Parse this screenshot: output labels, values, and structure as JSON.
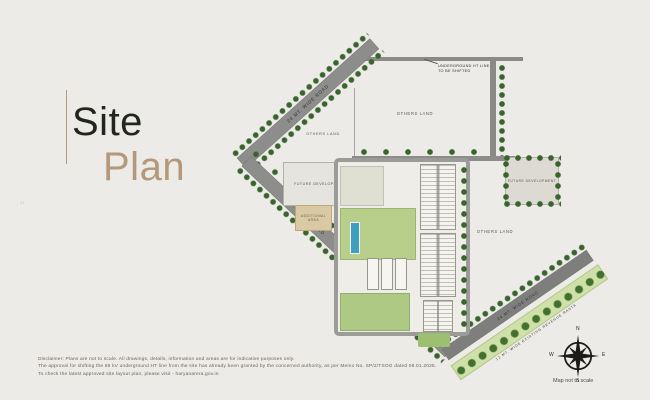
{
  "page": {
    "title_line1": "Site",
    "title_line2": "Plan",
    "page_mark": "17",
    "colors": {
      "accent_tan": "#b5987a",
      "title_dark": "#23261f",
      "road_gray": "#8d8d8b",
      "tree_green": "#3a642e",
      "lawn_green": "#b7cf8b",
      "pool_blue": "#3f9fbe",
      "additional_area_tan": "#d9c9a4"
    }
  },
  "map": {
    "labels": {
      "road_top_left": "24 MT. WIDE ROAD",
      "road_bottom_left": "24 MT. WIDE ROAD",
      "road_bottom_right": "24 MT. WIDE ROAD",
      "revenue_rasta": "12 MT. WIDE EXISTING REVENUE RASTA",
      "others_land_top_small": "OTHERS LAND",
      "others_land_top_large": "OTHERS LAND",
      "others_land_right": "OTHERS LAND",
      "future_development_left": "FUTURE DEVELOPMENT",
      "future_development_right": "FUTURE DEVELOPMENT",
      "additional_area_left": "ADDITIONAL AREA",
      "additional_area_mid": "ADDITIONAL AREA",
      "ht_callout_line1": "UNDERGROUND HT LINE",
      "ht_callout_line2": "TO BE SHIFTED"
    },
    "compass": {
      "north": "N",
      "east": "E",
      "south": "S",
      "west": "W",
      "caption": "Map not to scale"
    }
  },
  "disclaimer": {
    "line1": "Disclaimer: Plans are not to scale. All drawings, details, information and areas are for indicative purposes only.",
    "line2": "The approval for shifting the 66 kV underground HT line from the site has already been granted by the concerned authority, as per Memo No. SP/2/TSOG dated 08.01.2025.",
    "line3": "To check the latest approved site layout plan, please visit - haryanarera.gov.in"
  }
}
